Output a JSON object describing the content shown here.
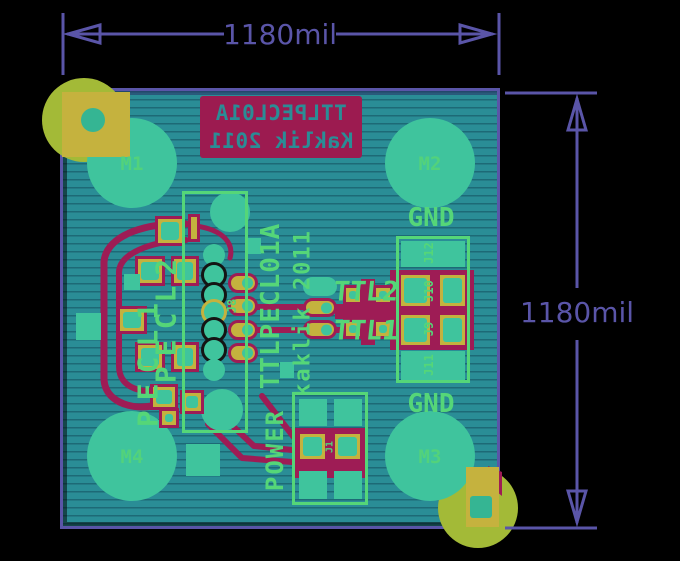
{
  "annotations": {
    "dimension_top": "1180mil",
    "dimension_right": "1180mil"
  },
  "board": {
    "silk_bottom_block": {
      "line1": "TTLPECL01A",
      "line2": "Kaklik 2011",
      "mirrored": true
    },
    "mount_holes": {
      "m1": "M1",
      "m2": "M2",
      "m3": "M3",
      "m4": "M4"
    },
    "silk_labels": {
      "gnd_top": "GND",
      "gnd_bottom": "GND",
      "power": "POWER",
      "ttl2": "TTL2",
      "ttl1": "TTL1",
      "pecl2": "PECL2",
      "pecl1": "PECL1",
      "title_vertical": "TTLPECL01A",
      "author_vertical": "kaklik 2011"
    },
    "ref_designators": {
      "j8": "J8",
      "j1": "J1",
      "j12": "J12",
      "j10": "J10",
      "j9": "J9",
      "j11": "J11"
    }
  },
  "colors": {
    "background": "#000000",
    "dimension_purple": "#5a55a8",
    "board_teal": "#2a8d96",
    "silk_green": "#55d678",
    "pad_yellow": "#c4b23e",
    "copper_red": "#9e1c55",
    "pad_hole_teal": "#3fc49d",
    "fiducial_chartreuse": "#a3ba37",
    "silk_red_block": "#9c1b50"
  }
}
